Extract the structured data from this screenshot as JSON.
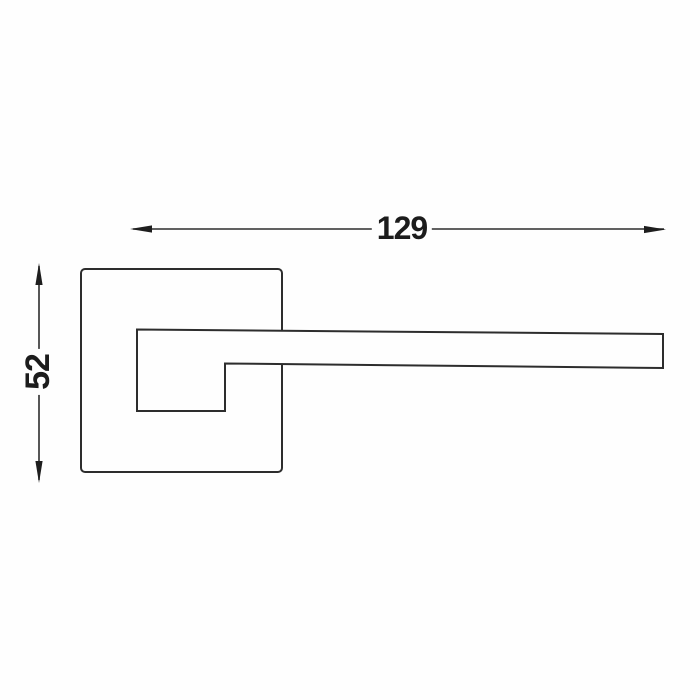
{
  "drawing": {
    "type": "technical-dimension-drawing",
    "subject": "Lever door handle on square rosette, side profile",
    "dimensions": {
      "width_label": "129",
      "height_label": "52"
    },
    "colors": {
      "line": "#2d2d2d",
      "arrow": "#1e1e1e",
      "text": "#1c1c1c",
      "background": "#fefefe"
    }
  }
}
